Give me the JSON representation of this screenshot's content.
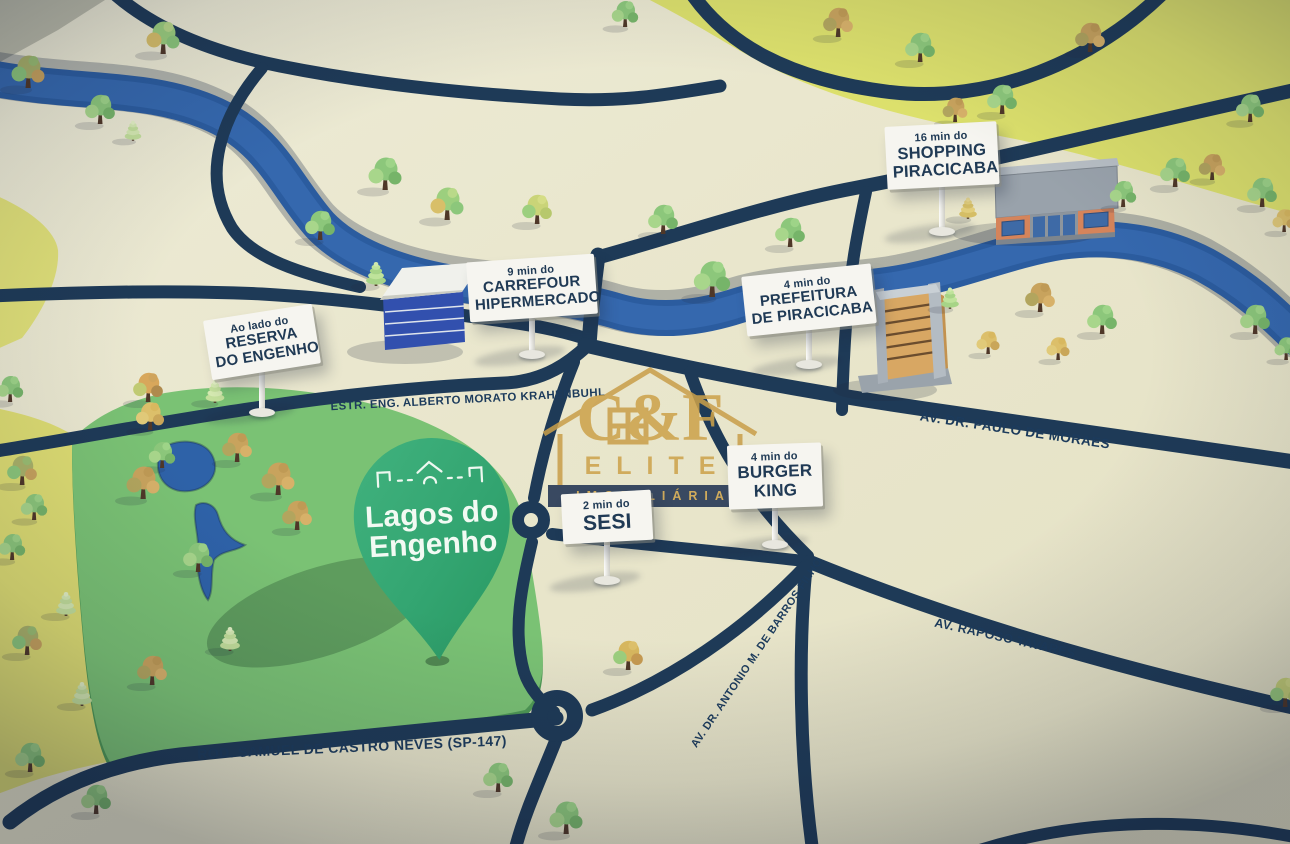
{
  "map": {
    "pin": {
      "line1": "Lagos do",
      "line2": "Engenho"
    },
    "signs": [
      {
        "id": "reserva-do-engenho",
        "pre": "Ao lado do",
        "lines": [
          "RESERVA",
          "DO ENGENHO"
        ]
      },
      {
        "id": "carrefour",
        "pre": "9 min do",
        "lines": [
          "CARREFOUR",
          "HIPERMERCADO"
        ]
      },
      {
        "id": "shopping-piracicaba",
        "pre": "16 min do",
        "lines": [
          "SHOPPING",
          "PIRACICABA"
        ]
      },
      {
        "id": "prefeitura",
        "pre": "4 min do",
        "lines": [
          "PREFEITURA",
          "DE PIRACICABA"
        ]
      },
      {
        "id": "burger-king",
        "pre": "4 min do",
        "lines": [
          "BURGER",
          "KING"
        ]
      },
      {
        "id": "sesi",
        "pre": "2 min do",
        "lines": [
          "SESI"
        ]
      }
    ],
    "roads": [
      {
        "id": "krahenbuhl",
        "label": "ESTR. ENG. ALBERTO MORATO KRAHENBUHL"
      },
      {
        "id": "paulo-de-moraes",
        "label": "AV. DR. PAULO DE MORAES"
      },
      {
        "id": "raposo-tavares",
        "label": "AV. RAPOSO TAVARES"
      },
      {
        "id": "antonio-barros-filho",
        "label": "AV. DR. ANTONIO M. DE BARROS FILHO"
      },
      {
        "id": "sp-147",
        "label": "ROD. SAMUEL DE CASTRO NEVES (SP-147)"
      }
    ],
    "watermark": {
      "line1": "C&F",
      "line2": "ELITE",
      "line3": "IMOBILIÁRIA"
    },
    "colors": {
      "ground": "#e9e6cc",
      "zone_yellow": "#dce06c",
      "field_green": "#7ac274",
      "pin_green": "#33a571",
      "road_navy": "#1e3a57",
      "river_blue": "#2f63a9",
      "sign_white": "#f6f5f0",
      "label_navy": "#1c3b5c",
      "watermark_gold": "#cda24a"
    }
  }
}
